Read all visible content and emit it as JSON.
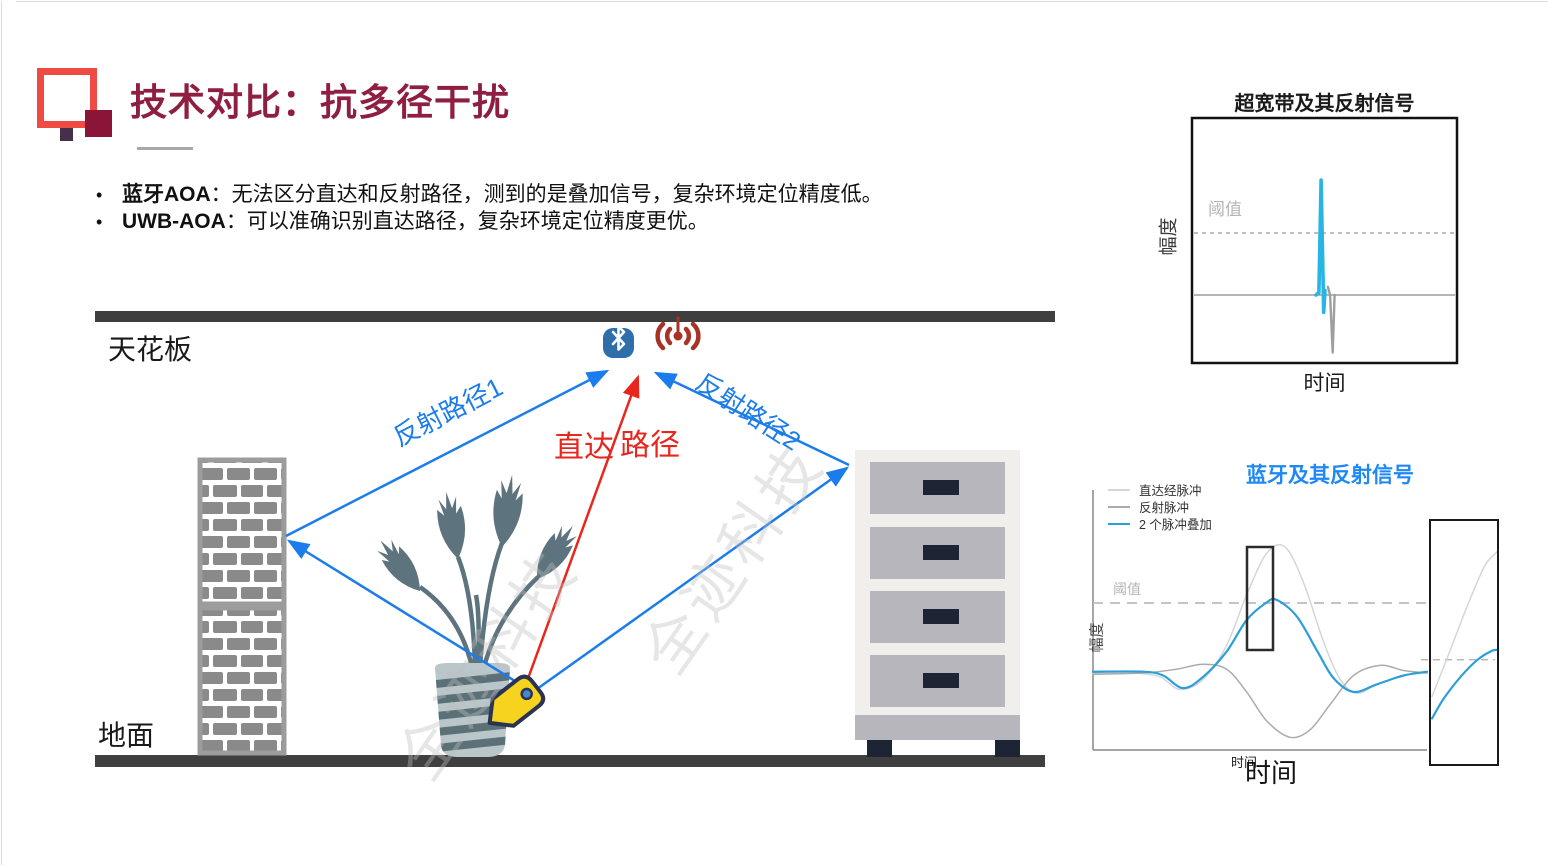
{
  "header": {
    "title": "技术对比：抗多径干扰",
    "title_color": "#8E1F41",
    "logo_colors": {
      "outline": "#F04A45",
      "corner": "#8B1538",
      "dot": "#463049"
    }
  },
  "bullets": [
    {
      "dot": "•",
      "lead": "蓝牙AOA",
      "text": "：无法区分直达和反射路径，测到的是叠加信号，复杂环境定位精度低。"
    },
    {
      "dot": "•",
      "lead": "UWB-AOA",
      "text": "：可以准确识别直达路径，复杂环境定位精度更优。"
    }
  ],
  "diagram": {
    "ceiling_label": "天花板",
    "ground_label": "地面",
    "reflect_path1_label": "反射路径1",
    "reflect_path2_label": "反射路径2",
    "direct_label_a": "直达",
    "direct_label_b": "路径",
    "watermark_text": "全迹科技",
    "icons": [
      "bluetooth-icon",
      "rf-signal-icon",
      "tag-icon"
    ],
    "colors": {
      "structure_gray": "#3F3F3F",
      "path_blue": "#1B7CEB",
      "path_red": "#E8261E",
      "bluetooth_blue": "#2E6EA9",
      "rf_red": "#A93226",
      "tag_yellow": "#F6D31F",
      "tag_outline": "#2A3350",
      "brick_gray": "#8A8A8A",
      "cabinet_body": "#F0EFEC",
      "cabinet_drawer": "#B7B6BC",
      "handle_navy": "#1D2433",
      "plant_slate": "#5D737E",
      "vase_blue": "#B9C7CB"
    }
  },
  "chart_data": [
    {
      "id": "uwb_chart",
      "type": "line",
      "title": "超宽带及其反射信号",
      "xlabel": "时间",
      "ylabel": "幅度",
      "threshold_label": "阈值",
      "threshold_level": 0.54,
      "baseline_level": 0,
      "grid": false,
      "legend_position": "none",
      "series": [
        {
          "name": "UWB直达脉冲",
          "color": "#27B5E3",
          "width": 3.6,
          "smooth": false,
          "points": [
            [
              0.468,
              0
            ],
            [
              0.479,
              0.02
            ],
            [
              0.487,
              1.0
            ],
            [
              0.497,
              -0.15
            ],
            [
              0.502,
              0.04
            ]
          ]
        },
        {
          "name": "UWB反射脉冲",
          "color": "#9E9E9E",
          "width": 2.4,
          "smooth": false,
          "points": [
            [
              0.513,
              0.07
            ],
            [
              0.521,
              0.0
            ],
            [
              0.531,
              -0.5
            ],
            [
              0.538,
              0.0
            ]
          ]
        }
      ]
    },
    {
      "id": "bt_chart",
      "type": "line",
      "title": "蓝牙及其反射信号",
      "title_color": "#1E88F7",
      "xlabel": "时间",
      "xlabel_secondary": "时间",
      "ylabel": "幅度",
      "threshold_label": "阈值",
      "threshold_level": 0.56,
      "grid": false,
      "legend_position": "top-left",
      "series": [
        {
          "name": "直达经脉冲",
          "color": "#D6D6D6",
          "width": 1.5,
          "smooth": true,
          "points": [
            [
              0,
              0
            ],
            [
              0.12,
              0
            ],
            [
              0.2,
              -0.03
            ],
            [
              0.26,
              -0.13
            ],
            [
              0.33,
              -0.05
            ],
            [
              0.4,
              0.22
            ],
            [
              0.46,
              0.62
            ],
            [
              0.52,
              0.95
            ],
            [
              0.575,
              1.0
            ],
            [
              0.63,
              0.72
            ],
            [
              0.69,
              0.25
            ],
            [
              0.74,
              -0.05
            ],
            [
              0.79,
              -0.16
            ],
            [
              0.85,
              -0.09
            ],
            [
              0.93,
              -0.02
            ],
            [
              1,
              0
            ]
          ]
        },
        {
          "name": "反射脉冲",
          "color": "#ABABAB",
          "width": 1.5,
          "smooth": true,
          "points": [
            [
              0,
              -0.01
            ],
            [
              0.15,
              0
            ],
            [
              0.25,
              0.03
            ],
            [
              0.33,
              0.07
            ],
            [
              0.4,
              0.03
            ],
            [
              0.46,
              -0.15
            ],
            [
              0.52,
              -0.38
            ],
            [
              0.59,
              -0.51
            ],
            [
              0.65,
              -0.45
            ],
            [
              0.71,
              -0.25
            ],
            [
              0.78,
              -0.02
            ],
            [
              0.86,
              0.06
            ],
            [
              0.93,
              0.02
            ],
            [
              1,
              0
            ]
          ]
        },
        {
          "name": "2 个脉冲叠加",
          "color": "#2D9FD8",
          "width": 2.2,
          "smooth": true,
          "points": [
            [
              0,
              0.01
            ],
            [
              0.15,
              0.01
            ],
            [
              0.21,
              -0.02
            ],
            [
              0.27,
              -0.12
            ],
            [
              0.33,
              -0.03
            ],
            [
              0.4,
              0.17
            ],
            [
              0.46,
              0.42
            ],
            [
              0.52,
              0.56
            ],
            [
              0.55,
              0.58
            ],
            [
              0.61,
              0.45
            ],
            [
              0.67,
              0.18
            ],
            [
              0.72,
              -0.04
            ],
            [
              0.78,
              -0.15
            ],
            [
              0.85,
              -0.09
            ],
            [
              0.93,
              -0.02
            ],
            [
              1,
              0.01
            ]
          ]
        }
      ],
      "highlight_box_note": "black rectangle marking the rising-edge region",
      "inset": {
        "note": "zoomed view of rising edge",
        "threshold_frac": 0.43,
        "series": [
          {
            "name": "直达经脉冲(放大)",
            "color": "#D6D6D6",
            "width": 1.5,
            "points": [
              [
                0.03,
                0.28
              ],
              [
                0.3,
                0.47
              ],
              [
                0.55,
                0.65
              ],
              [
                0.8,
                0.81
              ],
              [
                0.985,
                0.87
              ]
            ]
          },
          {
            "name": "2 个脉冲叠加(放大)",
            "color": "#2D9FD8",
            "width": 2.2,
            "points": [
              [
                0.03,
                0.19
              ],
              [
                0.2,
                0.27
              ],
              [
                0.45,
                0.36
              ],
              [
                0.7,
                0.43
              ],
              [
                0.9,
                0.465
              ],
              [
                0.985,
                0.47
              ]
            ]
          }
        ]
      }
    }
  ]
}
